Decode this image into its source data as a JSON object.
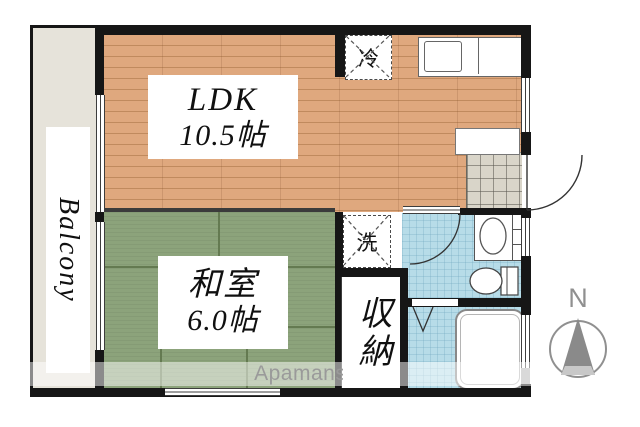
{
  "floorplan": {
    "rooms": {
      "ldk": {
        "label": "LDK",
        "size": "10.5帖"
      },
      "washitsu": {
        "label": "和室",
        "size": "6.0帖"
      },
      "storage": {
        "label": "収納"
      },
      "balcony": {
        "label": "Balcony"
      }
    },
    "fixtures": {
      "refrigerator": {
        "label": "冷"
      },
      "washer": {
        "label": "洗"
      },
      "kitchen_counter": "kitchen-counter-with-sink",
      "shoe_cabinet": "shoe-cabinet",
      "wash_basin": "wash-basin",
      "toilet": "toilet",
      "bathtub": "bathtub",
      "entrance_door": "entrance-door-swing",
      "washroom_door": "washroom-door-swing",
      "bath_door": "bath-folding-door"
    },
    "compass": {
      "north": "N"
    },
    "watermark": {
      "text": "Apamanshop"
    }
  },
  "colors": {
    "wall": "#161616",
    "wood": "#dfa87e",
    "wood_line": "#c08a5e",
    "tatami": "#8ca37b",
    "tatami_seam": "#647a51",
    "water": "#b7dce8",
    "tile": "#d9d5c9",
    "balcony": "#e6e3da",
    "watermark_text": "#9a9a9a",
    "compass": "#8f8f8f"
  }
}
